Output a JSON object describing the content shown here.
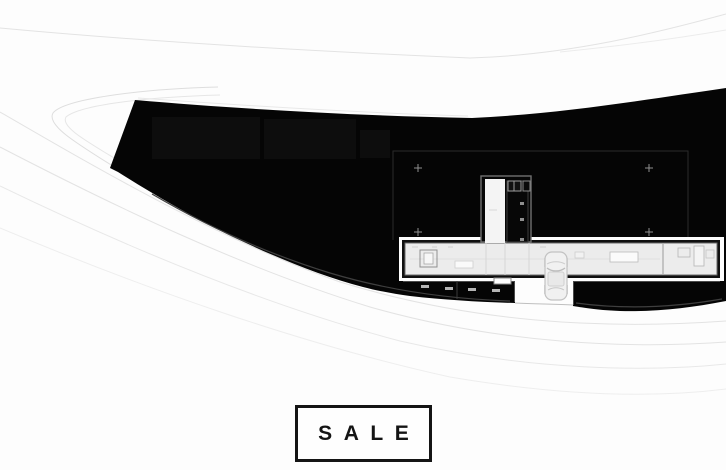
{
  "badge": {
    "label": "SALE"
  },
  "icons": {
    "car": "car-top-view-icon"
  },
  "colors": {
    "background": "#fdfdfd",
    "terrain_mass": "#050505",
    "contour_line": "#e3e3e3",
    "plan_floor": "#ececec",
    "plan_corridor": "#f4f4f4",
    "badge_border": "#141414",
    "badge_text": "#141414",
    "marker_cross": "#909090"
  }
}
